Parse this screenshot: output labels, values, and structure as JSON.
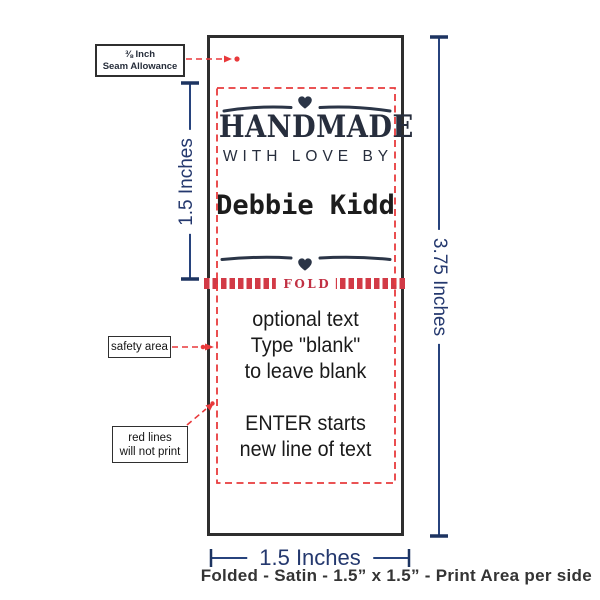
{
  "design": {
    "heart": "♥",
    "title": "HANDMADE",
    "subtitle": "WITH LOVE BY",
    "name": "Debbie Kidd",
    "fold": "FOLD"
  },
  "back_text": {
    "line1": "optional text",
    "line2": "Type \"blank\"",
    "line3": "to leave blank",
    "line4": "ENTER starts",
    "line5": "new line of text"
  },
  "callouts": {
    "seam_line1": "⅜ Inch",
    "seam_line2": "Seam Allowance",
    "safety": "safety area",
    "red_line1": "red lines",
    "red_line2": "will not print"
  },
  "dimensions": {
    "left": "1.5 Inches",
    "right": "3.75 Inches",
    "bottom": "1.5 Inches"
  },
  "caption": "Folded - Satin - 1.5” x 1.5” - Print Area per side",
  "colors": {
    "navy": "#27437d",
    "red": "#e8393b",
    "fold_red": "#d23a46",
    "ink": "#272e3d",
    "border": "#2e2e2e"
  }
}
